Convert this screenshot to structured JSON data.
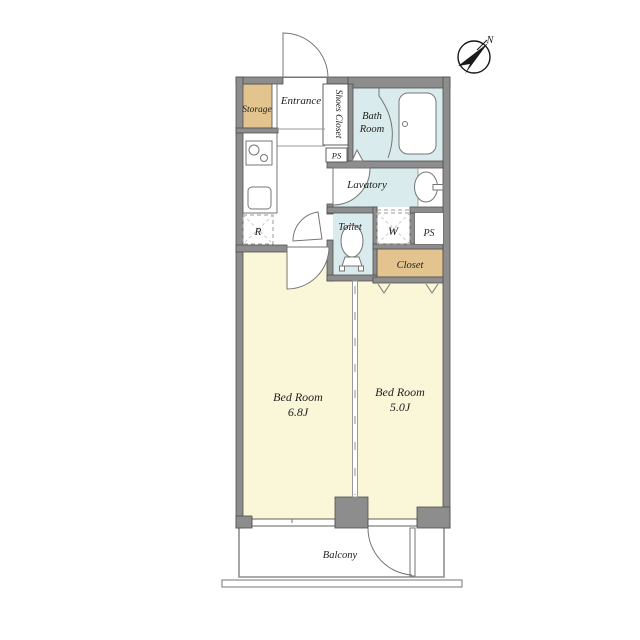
{
  "plan": {
    "compass_label": "N",
    "storage": "Storage",
    "entrance": "Entrance",
    "shoes_closet": "Shoes Closet",
    "ps_upper": "PS",
    "bath_line1": "Bath",
    "bath_line2": "Room",
    "lavatory": "Lavatory",
    "toilet": "Toilet",
    "washer": "W",
    "ps_right": "PS",
    "closet": "Closet",
    "refrigerator": "R",
    "bedroom_left_name": "Bed Room",
    "bedroom_left_size": "6.8J",
    "bedroom_right_name": "Bed Room",
    "bedroom_right_size": "5.0J",
    "balcony": "Balcony"
  },
  "colors": {
    "wall": "#8d8d8d",
    "wall_edge": "#4f4f4f",
    "room_yellow": "#faf7d9",
    "water_blue": "#d9ebec",
    "closet_tan": "#e3c48e",
    "fixture_line": "#757575",
    "dash_line": "#9a9a9a",
    "text": "#1e1e1e"
  }
}
